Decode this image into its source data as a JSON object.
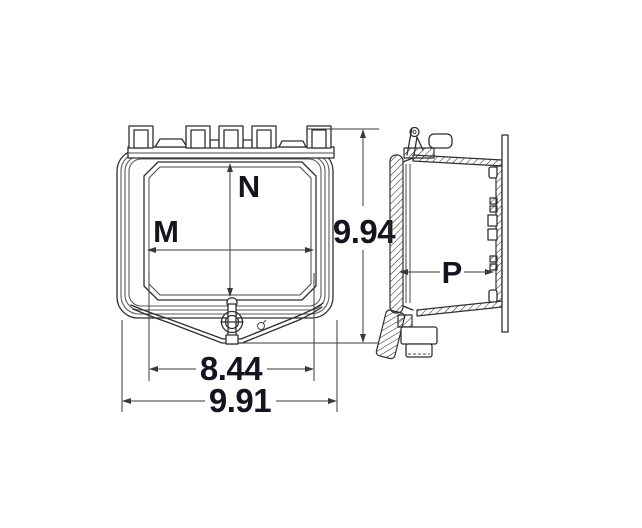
{
  "diagram": {
    "labels": {
      "n": "N",
      "m": "M",
      "p": "P",
      "height": "9.94",
      "inner_width": "8.44",
      "overall_width": "9.91"
    },
    "colors": {
      "line": "#2f2f2f",
      "text": "#14141f",
      "background": "#ffffff"
    }
  }
}
